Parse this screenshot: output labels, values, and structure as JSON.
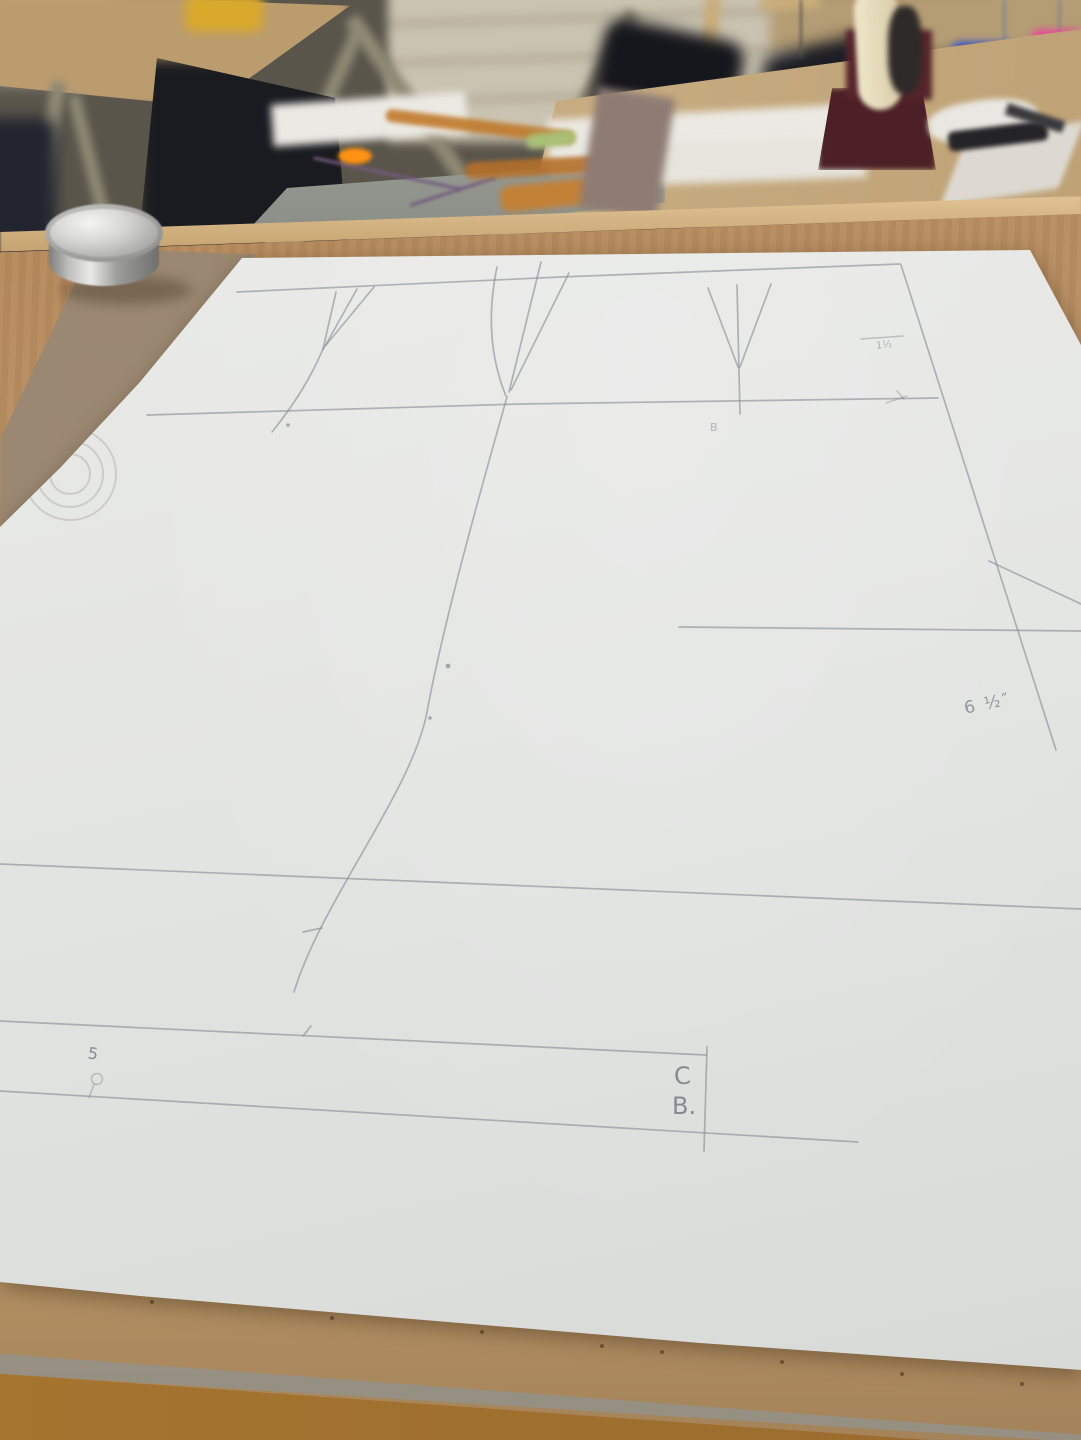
{
  "annotations": {
    "center_back_c": "C",
    "center_back_b": "B.",
    "measurement_6_5_in": "6 ½″",
    "notch_number_5": "5",
    "measurement_1_5": "1½",
    "point_label_b": "B"
  },
  "colors": {
    "paper": "#e7e8e6",
    "pencil": "#858a91",
    "work_table_wood": "#b68a5c",
    "bottom_wood": "#a5742f",
    "kraft_paper": "#9a8873",
    "metal_weight": "#d6d6d4",
    "tape_dispenser_maroon": "#4c2026",
    "tape_roll_cream": "#efe6c9",
    "ruler_orange": "#c07a2c",
    "ruler_glint_orange": "#ff9212",
    "dustpan_blue": "#2e52cf",
    "dustpan_pink": "#ee3f9c",
    "cabinet_beige": "#cac3b1",
    "floor_gray": "#5a554b",
    "dark_objects": "#1a1b20"
  }
}
